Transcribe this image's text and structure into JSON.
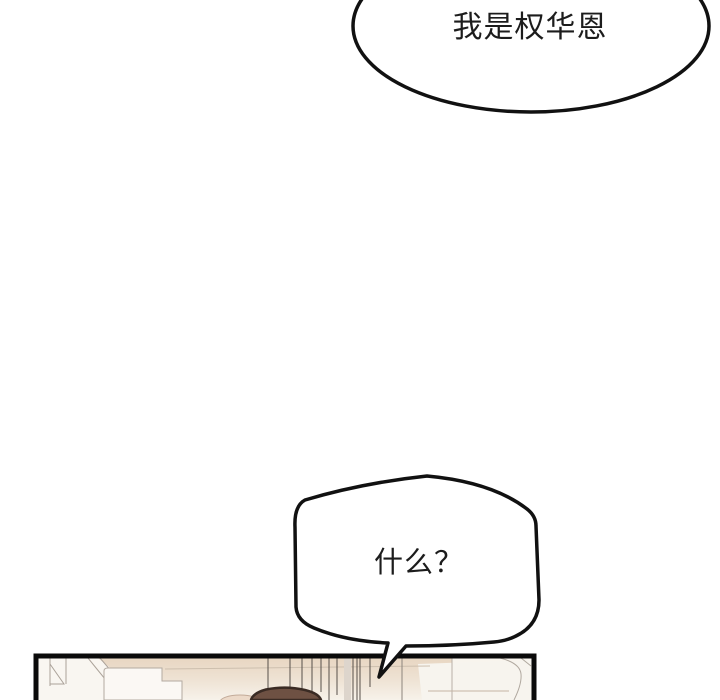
{
  "page": {
    "background": "#ffffff",
    "kind": "comic-page"
  },
  "bubbles": {
    "top": {
      "text": "我是权华恩"
    },
    "middle": {
      "text": "什么？"
    }
  },
  "colors": {
    "ink": "#111111",
    "bubble_fill": "#ffffff",
    "text": "#1c1c1c",
    "panel_border": "#0a0a0a",
    "panel_background": "#f8f4ed",
    "ceiling_beige": "#e8d6c2",
    "line_art_gray": "#aba299",
    "blind_line_dark": "#57504a",
    "hair": "#6e5143",
    "hair_outline": "#3a2b24"
  }
}
